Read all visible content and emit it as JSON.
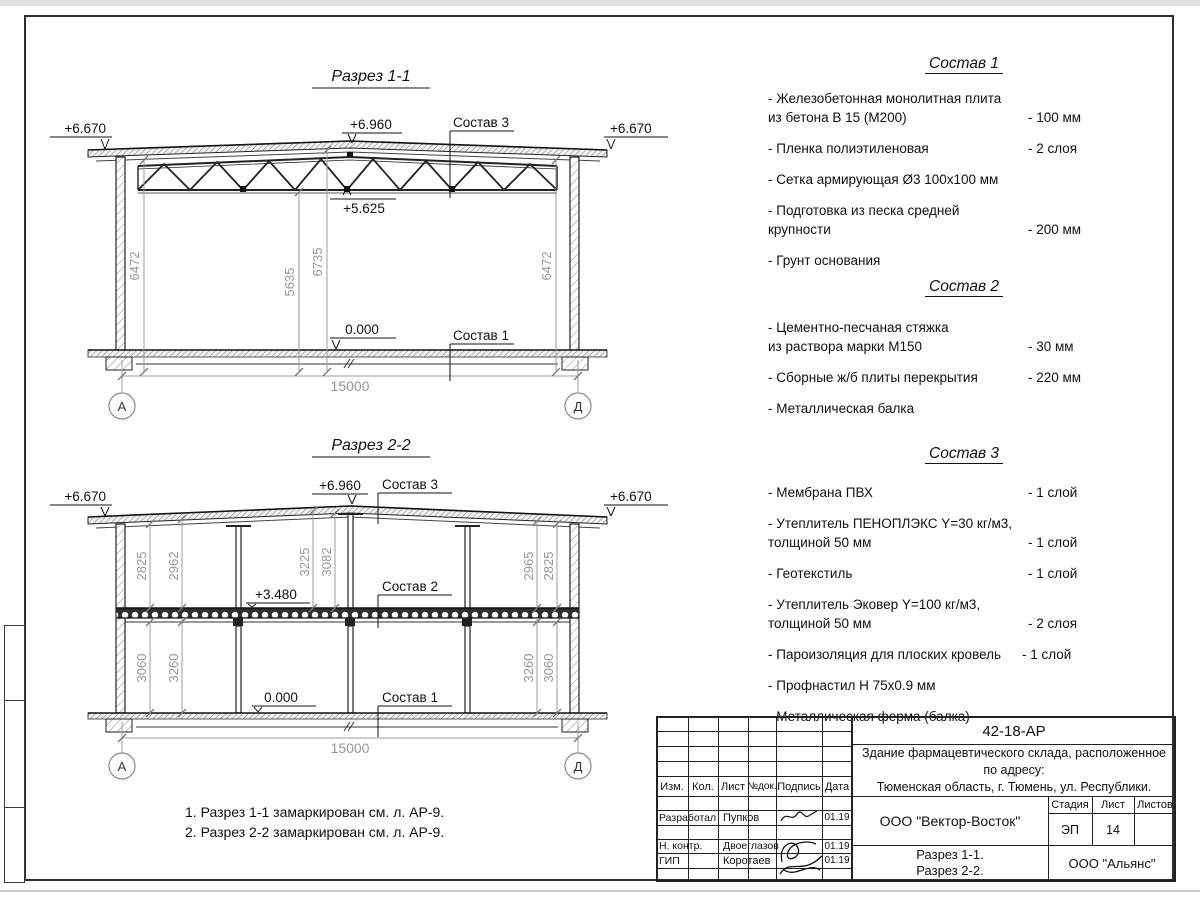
{
  "s1": {
    "title": "Разрез 1-1",
    "lvl_eaves_l": "+6.670",
    "lvl_eaves_r": "+6.670",
    "lvl_ridge": "+6.960",
    "lvl_chord": "+5.625",
    "lvl_floor": "0.000",
    "lbl_sostav3": "Состав 3",
    "lbl_sostav1": "Состав 1",
    "dim_left": "6472",
    "dim_mid1": "5635",
    "dim_mid2": "6735",
    "dim_right": "6472",
    "dim_span": "15000",
    "axis_l": "А",
    "axis_r": "Д"
  },
  "s2": {
    "title": "Разрез 2-2",
    "lvl_eaves_l": "+6.670",
    "lvl_eaves_r": "+6.670",
    "lvl_ridge": "+6.960",
    "lvl_floor2": "+3.480",
    "lvl_floor": "0.000",
    "lbl_sostav3": "Состав 3",
    "lbl_sostav2": "Состав 2",
    "lbl_sostav1": "Состав 1",
    "dims_up": [
      "2825",
      "2962",
      "3225",
      "3082",
      "2965",
      "2825"
    ],
    "dims_low": [
      "3060",
      "3260",
      "3260",
      "3060"
    ],
    "dim_span": "15000",
    "axis_l": "А",
    "axis_r": "Д"
  },
  "comp": [
    {
      "title": "Состав 1",
      "items": [
        {
          "t": "- Железобетонная  монолитная плита\nиз бетона В 15 (М200)",
          "v": "- 100 мм"
        },
        {
          "t": "- Пленка полиэтиленовая",
          "v": "-  2 слоя"
        },
        {
          "t": "- Сетка армирующая Ø3 100х100 мм",
          "v": ""
        },
        {
          "t": "- Подготовка из песка средней\nкрупности",
          "v": "- 200 мм"
        },
        {
          "t": "- Грунт основания",
          "v": ""
        }
      ]
    },
    {
      "title": "Состав 2",
      "items": [
        {
          "t": "- Цементно-песчаная стяжка\nиз раствора марки М150",
          "v": "- 30 мм"
        },
        {
          "t": "- Сборные ж/б плиты перекрытия",
          "v": "- 220 мм"
        },
        {
          "t": "- Металлическая балка",
          "v": ""
        }
      ]
    },
    {
      "title": "Состав 3",
      "items": [
        {
          "t": "- Мембрана ПВХ",
          "v": "- 1 слой"
        },
        {
          "t": "- Утеплитель ПЕНОПЛЭКС Y=30 кг/м3,\nтолщиной 50 мм",
          "v": "- 1 слой"
        },
        {
          "t": "- Геотекстиль",
          "v": "- 1 слой"
        },
        {
          "t": "- Утеплитель Эковер Y=100 кг/м3,\nтолщиной 50 мм",
          "v": "- 2 слоя"
        },
        {
          "t": "- Пароизоляция для плоских кровель",
          "v": "- 1 слой"
        },
        {
          "t": "- Профнастил Н 75х0.9 мм",
          "v": ""
        },
        {
          "t": "- Металлическая ферма (балка)",
          "v": ""
        }
      ]
    }
  ],
  "notes": "1. Разрез 1-1 замаркирован см. л. АР-9.\n2. Разрез 2-2 замаркирован см. л. АР-9.",
  "tb": {
    "doc": "42-18-АР",
    "object": "Здание фармацевтического склада, расположенное по адресу:\nТюменская область, г. Тюмень, ул. Республики.",
    "h_izm": "Изм.",
    "h_kol": "Кол.",
    "h_list": "Лист",
    "h_ndok": "№док.",
    "h_podp": "Подпись",
    "h_data": "Дата",
    "r1_role": "Разработал",
    "r1_name": "Пупков",
    "r1_date": "01.19",
    "r2_role": "Н. контр.",
    "r2_name": "Двоеглазов",
    "r2_date": "01.19",
    "r3_role": "ГИП",
    "r3_name": "Коротаев",
    "r3_date": "01.19",
    "org": "ООО \"Вектор-Восток\"",
    "stage_h": "Стадия",
    "list_h": "Лист",
    "listov_h": "Листов",
    "stage": "ЭП",
    "list": "14",
    "listov": "",
    "dwg": "Разрез 1-1.\nРазрез 2-2.",
    "contractor": "ООО \"Альянс\""
  },
  "colors": {
    "line": "#222222",
    "dim": "#979797",
    "accent": "#2f2f2f"
  }
}
